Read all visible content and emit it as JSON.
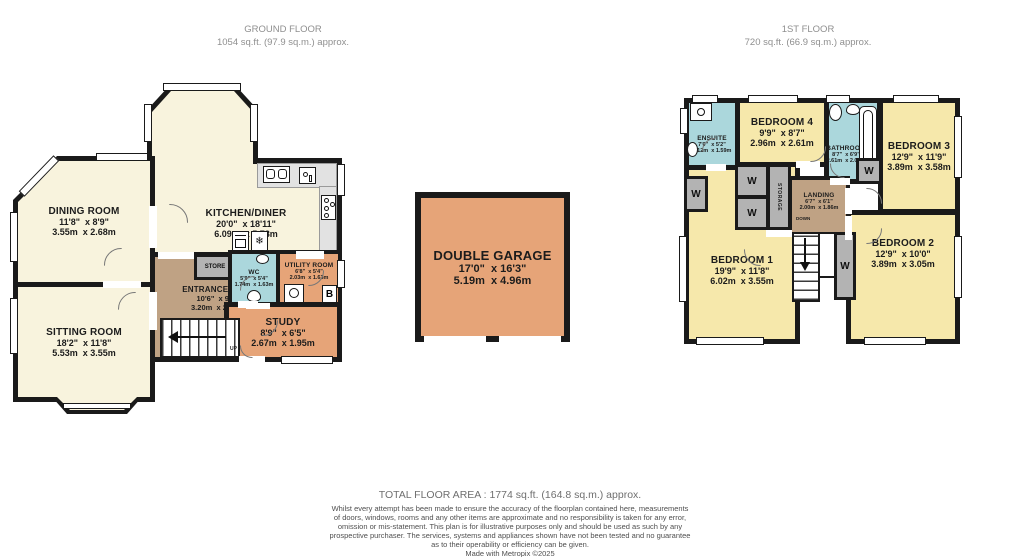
{
  "headers": {
    "ground": {
      "title": "GROUND FLOOR",
      "area": "1054 sq.ft. (97.9 sq.m.) approx."
    },
    "first": {
      "title": "1ST FLOOR",
      "area": "720 sq.ft. (66.9 sq.m.) approx."
    }
  },
  "ground_floor": {
    "dining_room": {
      "name": "DINING ROOM",
      "imperial": "11'8\"  x 8'9\"",
      "metric": "3.55m  x 2.68m"
    },
    "sitting_room": {
      "name": "SITTING ROOM",
      "imperial": "18'2\"  x 11'8\"",
      "metric": "5.53m  x 3.55m"
    },
    "kitchen_diner": {
      "name": "KITCHEN/DINER",
      "imperial": "20'0\"  x 18'11\"",
      "metric": "6.09m  x 5.78m"
    },
    "entrance_hall": {
      "name": "ENTRANCE HALL",
      "imperial": "10'6\"  x 9'9\"",
      "metric": "3.20m  x 2.98m"
    },
    "wc": {
      "name": "WC",
      "imperial": "5'9\"  x 5'4\"",
      "metric": "1.74m  x 1.63m"
    },
    "utility_room": {
      "name": "UTILITY ROOM",
      "imperial": "6'8\"  x 5'4\"",
      "metric": "2.03m  x 1.63m"
    },
    "study": {
      "name": "STUDY",
      "imperial": "8'9\"  x 6'5\"",
      "metric": "2.67m  x 1.95m"
    },
    "store_label": "STORE",
    "boiler_label": "B",
    "up_label": "UP"
  },
  "garage": {
    "name": "DOUBLE GARAGE",
    "imperial": "17'0\"  x 16'3\"",
    "metric": "5.19m  x 4.96m"
  },
  "first_floor": {
    "bedroom_1": {
      "name": "BEDROOM 1",
      "imperial": "19'9\"  x 11'8\"",
      "metric": "6.02m  x 3.55m"
    },
    "bedroom_2": {
      "name": "BEDROOM 2",
      "imperial": "12'9\"  x 10'0\"",
      "metric": "3.89m  x 3.05m"
    },
    "bedroom_3": {
      "name": "BEDROOM 3",
      "imperial": "12'9\"  x 11'9\"",
      "metric": "3.89m  x 3.58m"
    },
    "bedroom_4": {
      "name": "BEDROOM 4",
      "imperial": "9'9\"  x 8'7\"",
      "metric": "2.96m  x 2.61m"
    },
    "bathroom": {
      "name": "BATHROOM",
      "imperial": "8'7\"  x 6'9\"",
      "metric": "2.61m  x 2.05m"
    },
    "ensuite": {
      "name": "ENSUITE",
      "imperial": "7'0\"  x 5'2\"",
      "metric": "2.12m  x 1.59m"
    },
    "landing": {
      "name": "LANDING",
      "imperial": "6'7\"  x 6'1\"",
      "metric": "2.00m  x 1.86m"
    },
    "storage_label": "STORAGE",
    "wardrobe_label": "W",
    "down_label": "DOWN"
  },
  "icons": {
    "freezer_glyph": "❄"
  },
  "footer": {
    "total_area": "TOTAL FLOOR AREA : 1774 sq.ft. (164.8 sq.m.) approx.",
    "disclaimer_lines": [
      "Whilst every attempt has been made to ensure the accuracy of the floorplan contained here, measurements",
      "of doors, windows, rooms and any other items are approximate and no responsibility is taken for any error,",
      "omission or mis-statement. This plan is for illustrative purposes only and should be used as such by any",
      "prospective purchaser. The services, systems and appliances shown have not been tested and no guarantee",
      "as to their operability or efficiency can be given.",
      "Made with Metropix ©2025"
    ]
  },
  "colors": {
    "wall": "#1a1a1a",
    "reception": "#f8f3dd",
    "bedroom": "#f6e8ab",
    "wet_room": "#abd7dc",
    "hall": "#bfa284",
    "work_room": "#e6a478",
    "closet": "#b3b3b3",
    "counter": "#e2e2e2"
  }
}
